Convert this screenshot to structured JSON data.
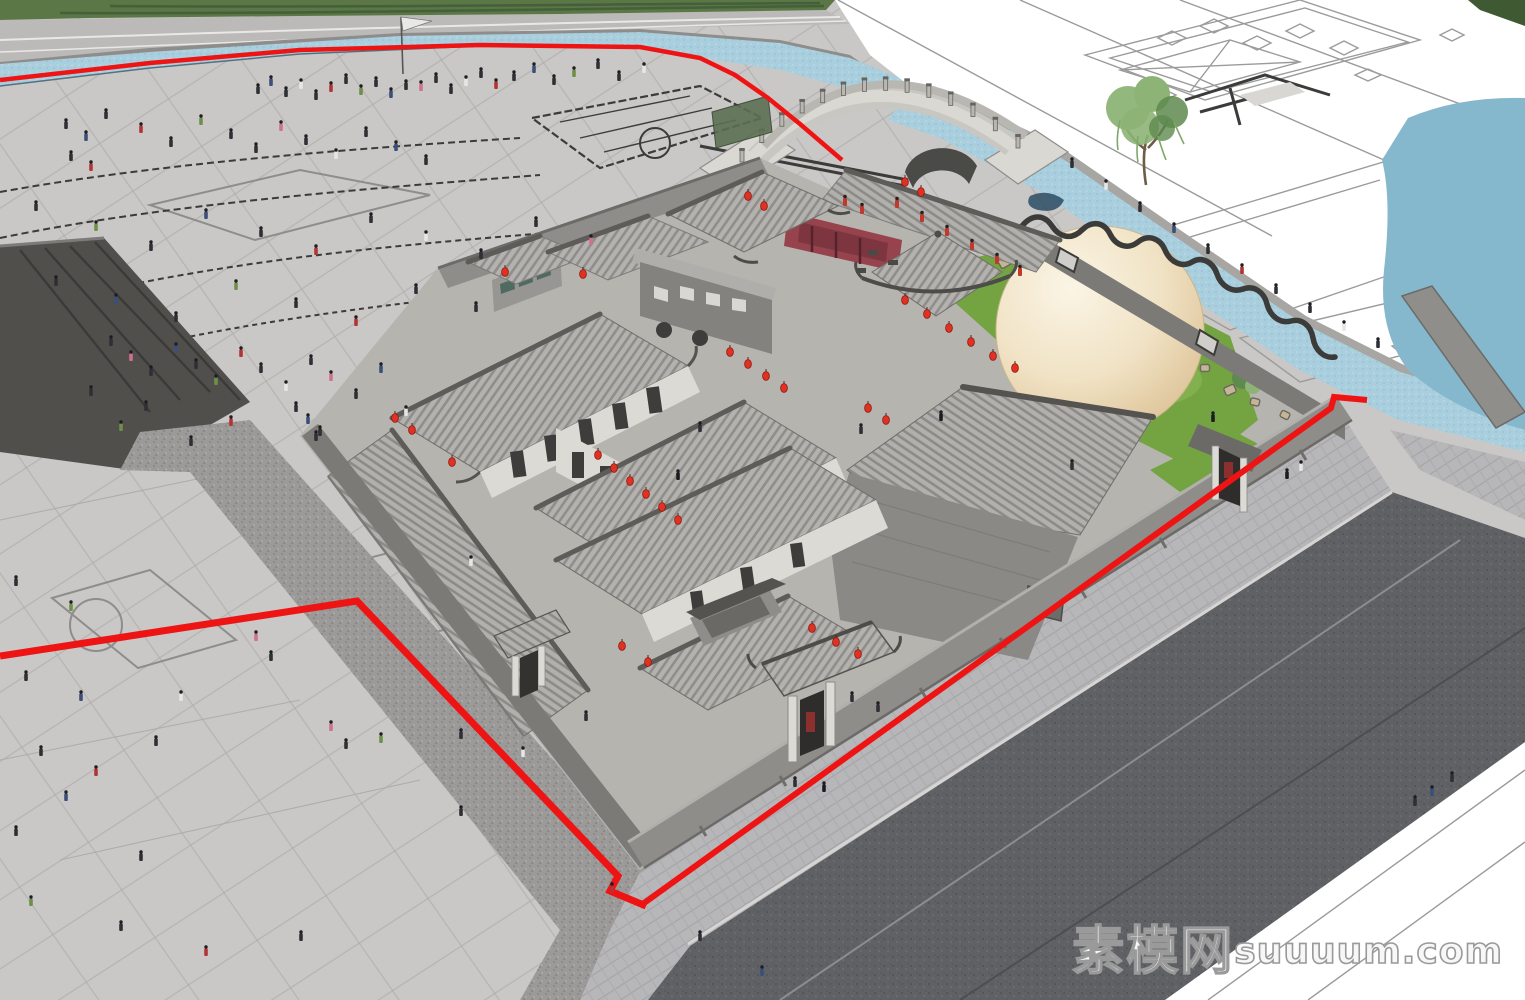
{
  "watermark": {
    "site_name": "素模网",
    "domain": "suuuum.com"
  },
  "palette": {
    "plaza": "#c9c8c6",
    "grid": "#aeadab",
    "gridBold": "#8e8d8b",
    "grass": "#5b7746",
    "grassDark": "#43603a",
    "roadBand": "#bbbab8",
    "curb": "#8e8d8b",
    "water": "#a9cedd",
    "waterDeep": "#86b8cd",
    "waterNavy": "#2b4d66",
    "white": "#ffffff",
    "planLine": "#9b9b9b",
    "planDark": "#3b3b39",
    "bridgeLight": "#dad8d3",
    "bridgeMid": "#b9b7b2",
    "bridgeDark": "#67655f",
    "roofBase": "#b4b2ae",
    "roofStripe": "#8f8d89",
    "ridge": "#5e5c58",
    "wallLight": "#a9a7a3",
    "wallMid": "#8f8d89",
    "wallDark": "#7c7a76",
    "gable": "#8b8985",
    "facade": "#dcdad4",
    "windowDark": "#3e3d3b",
    "maroon": "#97434e",
    "maroonDark": "#7d3640",
    "lantern": "#e03224",
    "lanternDark": "#8e170d",
    "red": "#ee1414",
    "lawn": "#74a341",
    "lawnLight": "#8ab555",
    "rock": "#c4b596",
    "rockLine": "#6b675f",
    "cobble": "#9b9a98",
    "asphalt": "#5f6164",
    "asphaltLineLight": "#8b8d90",
    "asphaltLineDark": "#4c4e51",
    "sidewalk": "#b7b6b8",
    "paver": "#a9a8aa",
    "sphereHi": "#faf3e2",
    "sphereLo": "#dec598",
    "treeGreen": "#8db476",
    "treeDark": "#5e8a4e",
    "gold": "#b8a869",
    "teal": "#4f6a60",
    "cream": "#dcdad4",
    "figureDark": "#2f2f36"
  },
  "scene": {
    "people_colors": {
      "d": "#2f2f36",
      "n": "#3c4f78",
      "r": "#b23434",
      "p": "#cf6f92",
      "g": "#6d9048",
      "w": "#e6e6e4",
      "t": "#8a6a4a",
      "k": "#1c1c20"
    },
    "people": [
      [
        258,
        94,
        "d"
      ],
      [
        271,
        86,
        "n"
      ],
      [
        286,
        97,
        "d"
      ],
      [
        301,
        89,
        "w"
      ],
      [
        316,
        100,
        "d"
      ],
      [
        331,
        92,
        "r"
      ],
      [
        346,
        84,
        "d"
      ],
      [
        361,
        95,
        "g"
      ],
      [
        376,
        87,
        "d"
      ],
      [
        391,
        98,
        "n"
      ],
      [
        406,
        90,
        "d"
      ],
      [
        421,
        91,
        "p"
      ],
      [
        436,
        83,
        "d"
      ],
      [
        451,
        94,
        "d"
      ],
      [
        466,
        86,
        "w"
      ],
      [
        481,
        78,
        "d"
      ],
      [
        496,
        89,
        "r"
      ],
      [
        514,
        81,
        "d"
      ],
      [
        534,
        73,
        "n"
      ],
      [
        554,
        85,
        "d"
      ],
      [
        574,
        77,
        "g"
      ],
      [
        598,
        69,
        "d"
      ],
      [
        619,
        81,
        "d"
      ],
      [
        644,
        73,
        "w"
      ],
      [
        66,
        129,
        "d"
      ],
      [
        86,
        141,
        "n"
      ],
      [
        106,
        119,
        "d"
      ],
      [
        141,
        133,
        "r"
      ],
      [
        171,
        147,
        "d"
      ],
      [
        201,
        125,
        "g"
      ],
      [
        231,
        139,
        "d"
      ],
      [
        256,
        153,
        "d"
      ],
      [
        281,
        131,
        "p"
      ],
      [
        306,
        145,
        "d"
      ],
      [
        336,
        159,
        "w"
      ],
      [
        366,
        137,
        "d"
      ],
      [
        396,
        151,
        "n"
      ],
      [
        426,
        165,
        "d"
      ],
      [
        71,
        161,
        "d"
      ],
      [
        91,
        171,
        "r"
      ],
      [
        36,
        211,
        "d"
      ],
      [
        96,
        231,
        "g"
      ],
      [
        151,
        251,
        "d"
      ],
      [
        206,
        219,
        "n"
      ],
      [
        261,
        237,
        "d"
      ],
      [
        316,
        255,
        "r"
      ],
      [
        371,
        223,
        "d"
      ],
      [
        426,
        241,
        "w"
      ],
      [
        481,
        259,
        "d"
      ],
      [
        536,
        227,
        "d"
      ],
      [
        591,
        245,
        "p"
      ],
      [
        56,
        286,
        "d"
      ],
      [
        116,
        304,
        "n"
      ],
      [
        176,
        322,
        "d"
      ],
      [
        236,
        290,
        "g"
      ],
      [
        296,
        308,
        "d"
      ],
      [
        356,
        326,
        "r"
      ],
      [
        416,
        294,
        "d"
      ],
      [
        476,
        312,
        "d"
      ],
      [
        111,
        346,
        "d"
      ],
      [
        131,
        361,
        "p"
      ],
      [
        151,
        376,
        "d"
      ],
      [
        176,
        353,
        "n"
      ],
      [
        196,
        369,
        "d"
      ],
      [
        216,
        385,
        "g"
      ],
      [
        241,
        357,
        "r"
      ],
      [
        261,
        373,
        "d"
      ],
      [
        286,
        391,
        "w"
      ],
      [
        311,
        365,
        "d"
      ],
      [
        331,
        381,
        "p"
      ],
      [
        356,
        399,
        "d"
      ],
      [
        381,
        373,
        "n"
      ],
      [
        146,
        411,
        "d"
      ],
      [
        231,
        426,
        "r"
      ],
      [
        316,
        441,
        "d"
      ],
      [
        121,
        431,
        "g"
      ],
      [
        191,
        446,
        "d"
      ],
      [
        91,
        396,
        "d"
      ],
      [
        406,
        416,
        "w"
      ],
      [
        296,
        412,
        "d"
      ],
      [
        308,
        424,
        "n"
      ],
      [
        320,
        436,
        "d"
      ],
      [
        16,
        586,
        "d"
      ],
      [
        71,
        611,
        "g"
      ],
      [
        26,
        681,
        "d"
      ],
      [
        81,
        701,
        "n"
      ],
      [
        41,
        756,
        "d"
      ],
      [
        96,
        776,
        "r"
      ],
      [
        156,
        746,
        "d"
      ],
      [
        181,
        701,
        "w"
      ],
      [
        256,
        641,
        "p"
      ],
      [
        271,
        661,
        "d"
      ],
      [
        331,
        731,
        "p"
      ],
      [
        346,
        749,
        "d"
      ],
      [
        381,
        743,
        "g"
      ],
      [
        461,
        739,
        "d"
      ],
      [
        471,
        566,
        "w"
      ],
      [
        16,
        836,
        "d"
      ],
      [
        66,
        801,
        "n"
      ],
      [
        141,
        861,
        "d"
      ],
      [
        31,
        906,
        "g"
      ],
      [
        121,
        931,
        "d"
      ],
      [
        206,
        956,
        "r"
      ],
      [
        301,
        941,
        "d"
      ],
      [
        461,
        816,
        "d"
      ],
      [
        523,
        757,
        "w"
      ],
      [
        586,
        721,
        "d"
      ],
      [
        612,
        893,
        "r"
      ],
      [
        795,
        787,
        "d"
      ],
      [
        824,
        792,
        "k"
      ],
      [
        700,
        941,
        "d"
      ],
      [
        762,
        976,
        "n"
      ],
      [
        852,
        702,
        "d"
      ],
      [
        878,
        712,
        "d"
      ],
      [
        1287,
        479,
        "k"
      ],
      [
        1301,
        471,
        "w"
      ],
      [
        1452,
        782,
        "d"
      ],
      [
        1432,
        796,
        "n"
      ],
      [
        1415,
        806,
        "d"
      ],
      [
        1072,
        168,
        "d"
      ],
      [
        1106,
        190,
        "w"
      ],
      [
        1140,
        212,
        "d"
      ],
      [
        1174,
        233,
        "n"
      ],
      [
        1208,
        254,
        "d"
      ],
      [
        1242,
        274,
        "r"
      ],
      [
        1276,
        294,
        "d"
      ],
      [
        1310,
        313,
        "d"
      ],
      [
        1344,
        331,
        "w"
      ],
      [
        1378,
        348,
        "d"
      ],
      [
        678,
        480,
        "k"
      ],
      [
        700,
        432,
        "d"
      ],
      [
        861,
        434,
        "d"
      ],
      [
        941,
        421,
        "k"
      ],
      [
        1072,
        470,
        "d"
      ],
      [
        1213,
        422,
        "k"
      ]
    ],
    "red_figures": [
      [
        897,
        208
      ],
      [
        922,
        222
      ],
      [
        947,
        236
      ],
      [
        972,
        250
      ],
      [
        997,
        264
      ],
      [
        1020,
        276
      ],
      [
        845,
        206
      ],
      [
        862,
        214
      ]
    ],
    "lanterns": [
      [
        505,
        272
      ],
      [
        583,
        274
      ],
      [
        748,
        196
      ],
      [
        764,
        206
      ],
      [
        905,
        182
      ],
      [
        921,
        192
      ],
      [
        730,
        352
      ],
      [
        748,
        364
      ],
      [
        766,
        376
      ],
      [
        784,
        388
      ],
      [
        598,
        455
      ],
      [
        614,
        468
      ],
      [
        630,
        481
      ],
      [
        646,
        494
      ],
      [
        662,
        507
      ],
      [
        678,
        520
      ],
      [
        905,
        300
      ],
      [
        927,
        314
      ],
      [
        949,
        328
      ],
      [
        971,
        342
      ],
      [
        993,
        356
      ],
      [
        1015,
        368
      ],
      [
        622,
        646
      ],
      [
        648,
        662
      ],
      [
        812,
        628
      ],
      [
        836,
        642
      ],
      [
        858,
        654
      ],
      [
        395,
        418
      ],
      [
        412,
        430
      ],
      [
        452,
        462
      ],
      [
        886,
        420
      ],
      [
        868,
        408
      ]
    ],
    "stones": [
      [
        1005,
        262,
        12
      ],
      [
        1022,
        272,
        10
      ],
      [
        1040,
        282,
        13
      ],
      [
        1012,
        292,
        9
      ],
      [
        1030,
        300,
        11
      ],
      [
        1048,
        308,
        10
      ],
      [
        1065,
        296,
        12
      ],
      [
        1058,
        272,
        9
      ],
      [
        1158,
        308,
        13
      ],
      [
        1175,
        320,
        10
      ],
      [
        1192,
        332,
        14
      ],
      [
        1210,
        344,
        11
      ],
      [
        1228,
        356,
        13
      ],
      [
        1246,
        368,
        10
      ],
      [
        1264,
        380,
        12
      ],
      [
        1282,
        392,
        10
      ],
      [
        1300,
        404,
        13
      ],
      [
        1205,
        368,
        9
      ],
      [
        1230,
        390,
        11
      ],
      [
        1255,
        402,
        9
      ],
      [
        1180,
        352,
        10
      ],
      [
        1285,
        415,
        9
      ],
      [
        1310,
        418,
        11
      ]
    ],
    "red_lines": [
      {
        "pts": [
          [
            0,
            80
          ],
          [
            150,
            63
          ],
          [
            300,
            50
          ],
          [
            480,
            45
          ],
          [
            640,
            47
          ],
          [
            700,
            58
          ],
          [
            735,
            75
          ],
          [
            768,
            98
          ],
          [
            800,
            124
          ],
          [
            828,
            148
          ],
          [
            842,
            160
          ]
        ],
        "w": 4.5
      },
      {
        "pts": [
          [
            0,
            656
          ],
          [
            357,
            601
          ],
          [
            618,
            876
          ],
          [
            610,
            891
          ],
          [
            646,
            906
          ]
        ],
        "w": 7
      },
      {
        "pts": [
          [
            640,
            906
          ],
          [
            1331,
            408
          ],
          [
            1334,
            397
          ],
          [
            1367,
            400
          ]
        ],
        "w": 6
      }
    ],
    "bridge": {
      "p0": [
        742,
        164
      ],
      "c": [
        870,
        28
      ],
      "p1": [
        1018,
        150
      ],
      "posts": 13
    },
    "sphere": {
      "cx": 1100,
      "cy": 330,
      "r": 104
    }
  }
}
